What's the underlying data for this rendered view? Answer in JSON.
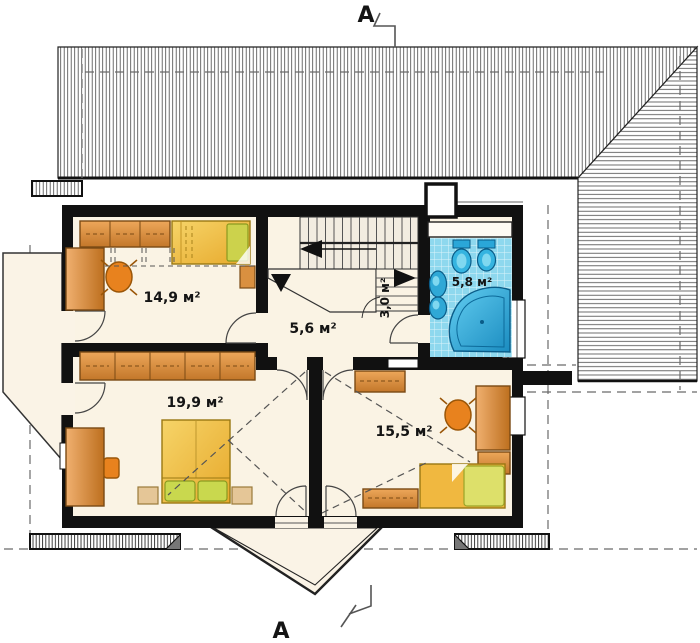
{
  "section_marks": {
    "top": "A",
    "bottom": "A"
  },
  "rooms": [
    {
      "id": "bedroom-top-left",
      "area_label": "14,9 м²"
    },
    {
      "id": "hall",
      "area_label": "5,6 м²"
    },
    {
      "id": "stair-closet",
      "area_label": "3,0 м²"
    },
    {
      "id": "bathroom",
      "area_label": "5,8 м²"
    },
    {
      "id": "bedroom-bottom-left",
      "area_label": "19,9 м²"
    },
    {
      "id": "bedroom-bottom-right",
      "area_label": "15,5 м²"
    }
  ],
  "colors": {
    "wall": "#111111",
    "floor": "#faf3e4",
    "furniture_orange": "#dc9340",
    "bed_yellow": "#efc23c",
    "pillow_green": "#ccd24c",
    "bathroom_tile": "#8ed8ee",
    "fixture_blue": "#2aa6d8",
    "chair_orange": "#e8821e"
  }
}
